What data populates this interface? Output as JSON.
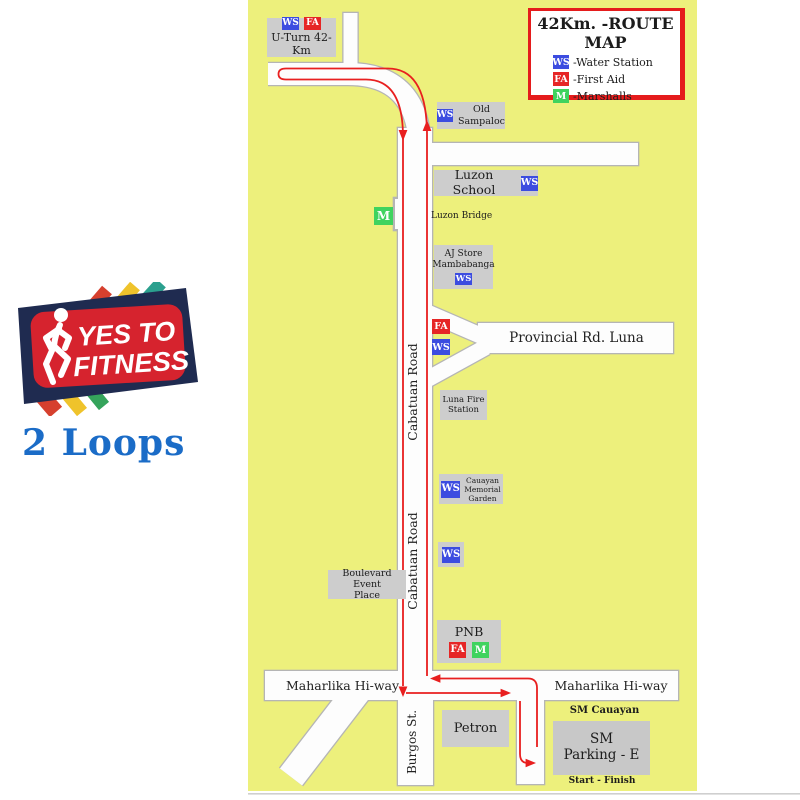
{
  "branding": {
    "logo_top": "YES TO",
    "logo_bottom": "FITNESS",
    "loops_label": "2 Loops"
  },
  "legend": {
    "title": "42Km. -ROUTE MAP",
    "items": [
      {
        "code": "WS",
        "label": "-Water Station"
      },
      {
        "code": "FA",
        "label": "-First Aid"
      },
      {
        "code": "M",
        "label": "-Marshalls"
      }
    ]
  },
  "badge_codes": {
    "water_station": "WS",
    "first_aid": "FA",
    "marshall": "M"
  },
  "roads": {
    "cabatuan": "Cabatuan Road",
    "burgos": "Burgos St.",
    "maharlika_left": "Maharlika Hi-way",
    "maharlika_right": "Maharlika Hi-way",
    "provincial": "Provincial Rd. Luna",
    "luzon_bridge": "Luzon Bridge"
  },
  "places": {
    "uturn": "U-Turn 42-Km",
    "old_sampaloc": {
      "line1": "Old",
      "line2": "Sampaloc"
    },
    "luzon_school": "Luzon School",
    "aj_store": {
      "line1": "AJ Store",
      "line2": "Mambabanga"
    },
    "luna_fire": {
      "line1": "Luna Fire",
      "line2": "Station"
    },
    "cauayan_memorial": {
      "line1": "Cauayan",
      "line2": "Memorial",
      "line3": "Garden"
    },
    "boulevard": {
      "line1": "Boulevard Event",
      "line2": "Place"
    },
    "pnb": "PNB",
    "petron": "Petron",
    "sm_cauayan": "SM Cauayan",
    "sm_parking": {
      "line1": "SM",
      "line2": "Parking - E"
    },
    "start_finish": "Start - Finish"
  },
  "colors": {
    "map_background": "#edf07c",
    "road_fill": "#fdfdfd",
    "road_casing": "#b5b5b5",
    "label_box": "#cdcdcd",
    "water_station_blue": "#3c4ce0",
    "first_aid_red": "#e62626",
    "marshall_green": "#3fd35f",
    "route_red": "#e81f1f",
    "legend_border_red": "#e51c1c",
    "loops_blue": "#1b6cc7",
    "logo_navy": "#1f2b50",
    "logo_red": "#d6232e"
  }
}
